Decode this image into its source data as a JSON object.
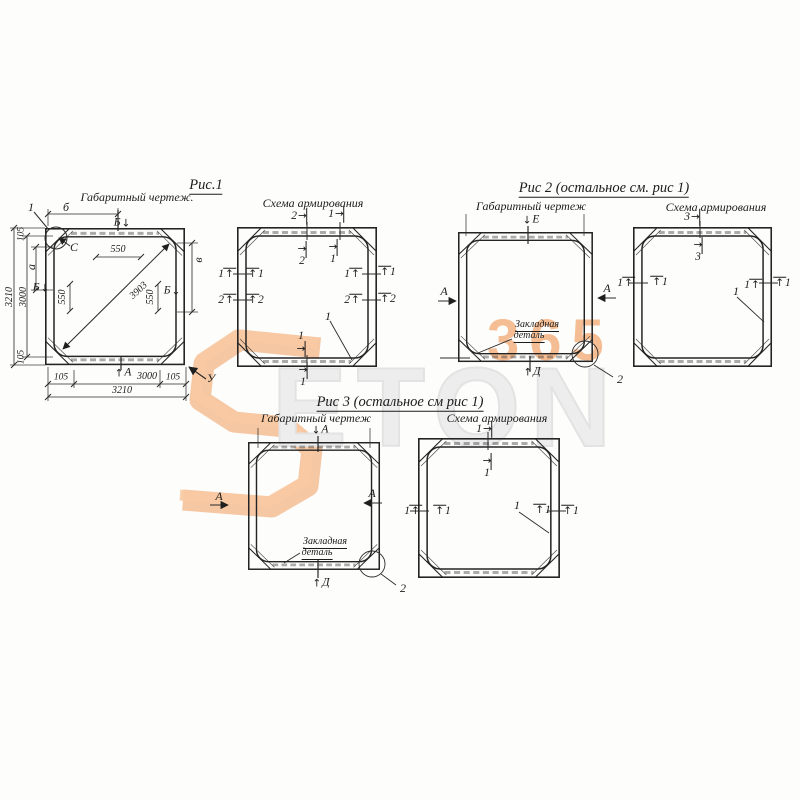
{
  "icons": {
    "arrow_up": "↑",
    "arrow_down": "↓",
    "arrow_left": "←",
    "arrow_right": "→"
  },
  "watermark": {
    "word": "ETON",
    "number": "365",
    "orange": "#ee7e2c",
    "gray": "#ededed"
  },
  "fig1": {
    "title": "Рис.1",
    "gab_caption": "Габаритный чертеж.",
    "scheme_caption": "Схема армирования",
    "detail_mark": "1",
    "corner_mark": "С",
    "dim_top_letter": "б",
    "section_b": "Б",
    "dim_550": "550",
    "dim_left_letter": "а",
    "dim_right_letter": "в",
    "dim_diagonal": "3903",
    "dim_105": "105",
    "dim_3000": "3000",
    "dim_3210": "3210",
    "section_a": "А",
    "corner_u": "У",
    "bar_1": "1",
    "bar_2": "2"
  },
  "fig2": {
    "title": "Рис 2 (остальное см. рис 1)",
    "gab_caption": "Габаритный чертеж",
    "scheme_caption": "Схема армирования",
    "section_e": "Е",
    "section_a": "А",
    "section_d": "Д",
    "embed_line1": "Закладная",
    "embed_line2": "деталь",
    "detail_2": "2",
    "bar_1": "1",
    "bar_3": "3"
  },
  "fig3": {
    "title": "Рис 3 (остальное см рис 1)",
    "gab_caption": "Габаритный чертеж",
    "scheme_caption": "Схема армирования",
    "section_a": "А",
    "section_d": "Д",
    "embed_line1": "Закладная",
    "embed_line2": "деталь",
    "detail_2": "2",
    "bar_1": "1"
  }
}
